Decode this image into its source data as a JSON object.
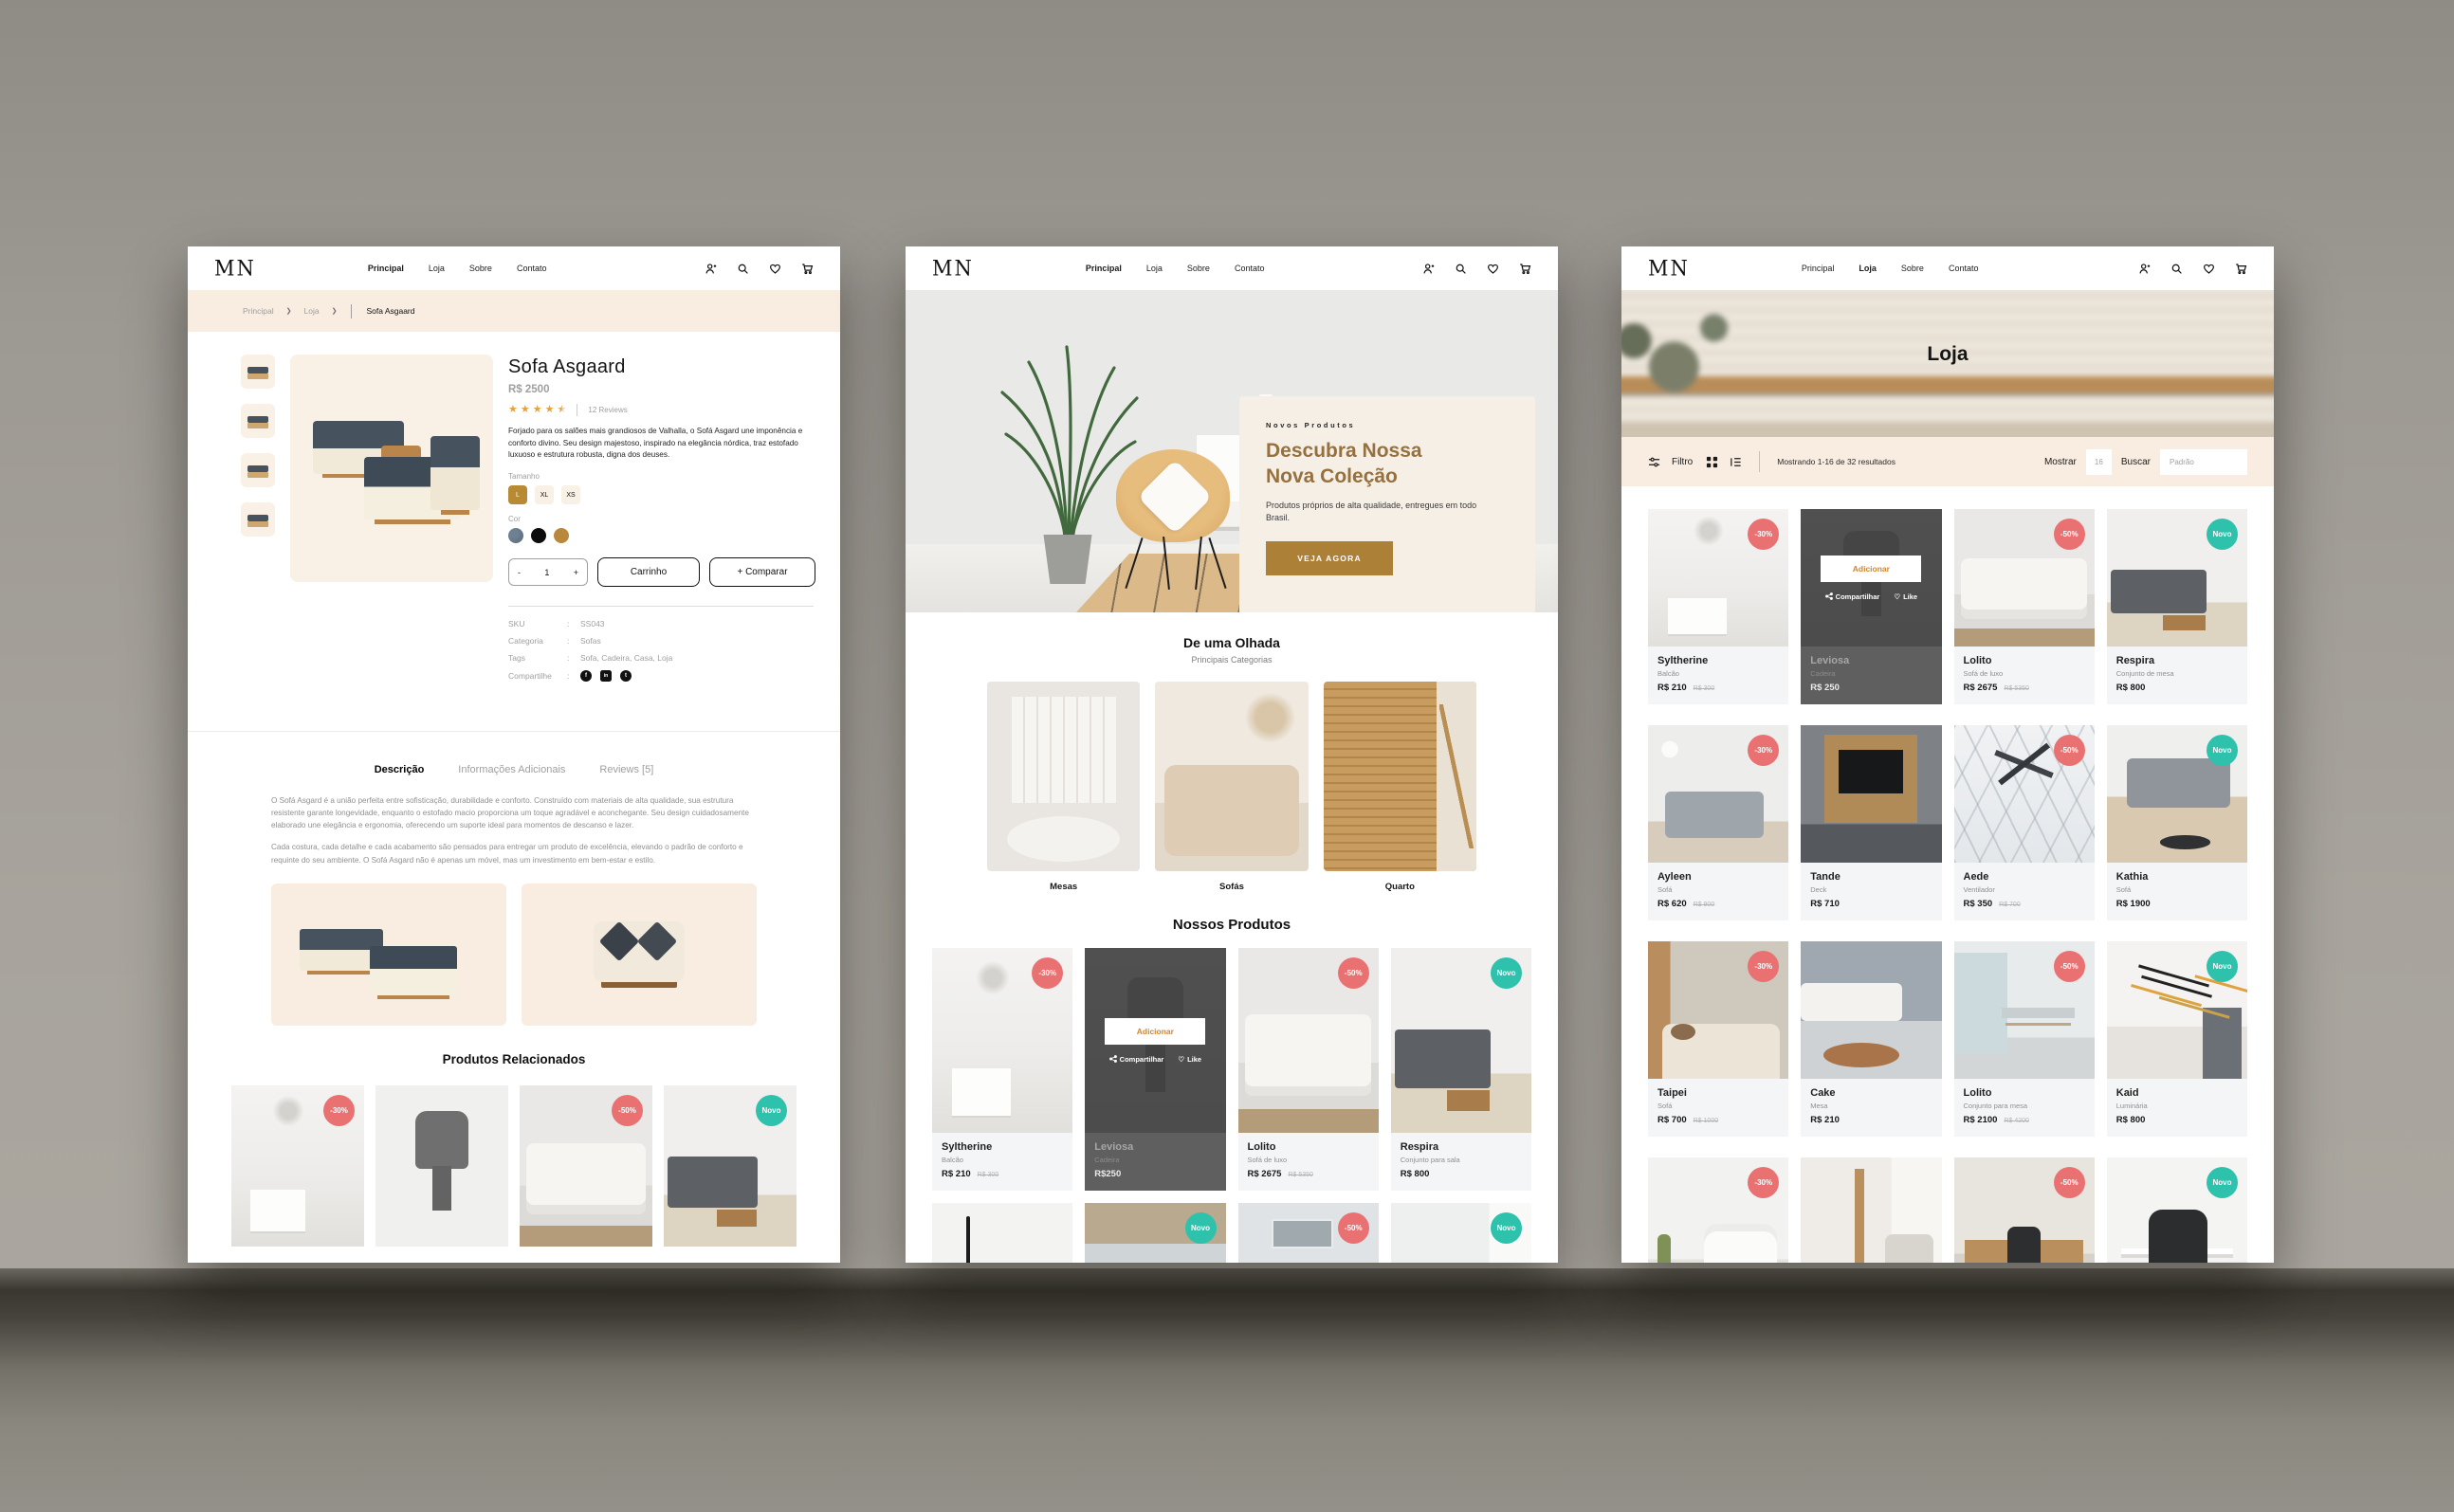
{
  "theme": {
    "accent": "#b88e2f",
    "sale_badge": "#e97171",
    "new_badge": "#2ec1ac",
    "cream": "#f9ece1",
    "cta_brown": "#ad8037"
  },
  "brand": {
    "logo": "MN"
  },
  "nav": {
    "items": [
      "Principal",
      "Loja",
      "Sobre",
      "Contato"
    ]
  },
  "icons": {
    "chevron": "❯",
    "star": "★",
    "heart": "♡",
    "facebook": "f",
    "linkedin": "in",
    "twitter": "t"
  },
  "hover": {
    "add": "Adicionar",
    "share": "Compartilhar",
    "like": "Like"
  },
  "detail": {
    "breadcrumb": {
      "items": [
        "Principal",
        "Loja"
      ],
      "current": "Sofa Asgaard"
    },
    "title": "Sofa Asgaard",
    "price": "R$ 2500",
    "reviews": "12 Reviews",
    "summary": "Forjado para os salões mais grandiosos de Valhalla, o Sofá Asgard une imponência e conforto divino. Seu design majestoso, inspirado na elegância nórdica, traz estofado luxuoso e estrutura robusta, digna dos deuses.",
    "size_label": "Tamanho",
    "sizes": [
      "L",
      "XL",
      "XS"
    ],
    "color_label": "Cor",
    "qty": {
      "minus": "-",
      "value": "1",
      "plus": "+"
    },
    "cart_button": "Carrinho",
    "compare_button": "+ Comparar",
    "meta": {
      "sep": ":",
      "sku_label": "SKU",
      "sku": "SS043",
      "cat_label": "Categoria",
      "cat": "Sofas",
      "tags_label": "Tags",
      "tags": "Sofa, Cadeira, Casa, Loja",
      "share_label": "Compartilhe"
    },
    "tabs": [
      "Descrição",
      "Informações Adicionais",
      "Reviews [5]"
    ],
    "paragraphs": [
      "O Sofá Asgard é a união perfeita entre sofisticação, durabilidade e conforto. Construído com materiais de alta qualidade, sua estrutura resistente garante longevidade, enquanto o estofado macio proporciona um toque agradável e aconchegante. Seu design cuidadosamente elaborado une elegância e ergonomia, oferecendo um suporte ideal para momentos de descanso e lazer.",
      "Cada costura, cada detalhe e cada acabamento são pensados para entregar um produto de excelência, elevando o padrão de conforto e requinte do seu ambiente. O Sofá Asgard não é apenas um móvel, mas um investimento em bem-estar e estilo."
    ],
    "related_title": "Produtos Relacionados",
    "related": [
      {
        "badge": "-30%"
      },
      {
        "badge": ""
      },
      {
        "badge": "-50%"
      },
      {
        "badge": "Novo"
      }
    ]
  },
  "home": {
    "hero": {
      "eyebrow": "Novos Produtos",
      "title1": "Descubra Nossa",
      "title2": "Nova Coleção",
      "text": "Produtos próprios de alta qualidade, entregues em todo Brasil.",
      "cta": "VEJA AGORA"
    },
    "glance_title": "De uma Olhada",
    "glance_subtitle": "Principais Categorias",
    "categories": [
      "Mesas",
      "Sofás",
      "Quarto"
    ],
    "products_title": "Nossos Produtos",
    "products": [
      {
        "name": "Syltherine",
        "category": "Balcão",
        "price": "R$ 210",
        "old_price": "R$ 300",
        "badge": "-30%"
      },
      {
        "name": "Leviosa",
        "category": "Cadeira",
        "price": "R$250"
      },
      {
        "name": "Lolito",
        "category": "Sofá de luxo",
        "price": "R$ 2675",
        "old_price": "R$ 5350",
        "badge": "-50%"
      },
      {
        "name": "Respira",
        "category": "Conjunto para sala",
        "price": "R$ 800",
        "badge": "Novo"
      }
    ],
    "partial_badges": [
      "",
      "Novo",
      "-50%",
      "Novo"
    ]
  },
  "shop": {
    "hero_title": "Loja",
    "toolbar": {
      "filter": "Filtro",
      "results": "Mostrando 1-16 de 32 resultados",
      "show_label": "Mostrar",
      "show_value": "16",
      "sort_label": "Buscar",
      "sort_value": "Padrão"
    },
    "products": [
      {
        "name": "Syltherine",
        "category": "Balcão",
        "price": "R$ 210",
        "old_price": "R$ 300",
        "badge": "-30%"
      },
      {
        "name": "Leviosa",
        "category": "Cadeira",
        "price": "R$ 250"
      },
      {
        "name": "Lolito",
        "category": "Sofá de luxo",
        "price": "R$ 2675",
        "old_price": "R$ 5350",
        "badge": "-50%"
      },
      {
        "name": "Respira",
        "category": "Conjunto de mesa",
        "price": "R$ 800",
        "badge": "Novo"
      },
      {
        "name": "Ayleen",
        "category": "Sofá",
        "price": "R$ 620",
        "old_price": "R$ 900",
        "badge": "-30%"
      },
      {
        "name": "Tande",
        "category": "Deck",
        "price": "R$ 710"
      },
      {
        "name": "Aede",
        "category": "Ventilador",
        "price": "R$ 350",
        "old_price": "R$ 700",
        "badge": "-50%"
      },
      {
        "name": "Kathia",
        "category": "Sofá",
        "price": "R$ 1900",
        "badge": "Novo"
      },
      {
        "name": "Taipei",
        "category": "Sofá",
        "price": "R$ 700",
        "old_price": "R$ 1000",
        "badge": "-30%"
      },
      {
        "name": "Cake",
        "category": "Mesa",
        "price": "R$ 210"
      },
      {
        "name": "Lolito",
        "category": "Conjunto para mesa",
        "price": "R$ 2100",
        "old_price": "R$ 4200",
        "badge": "-50%"
      },
      {
        "name": "Kaid",
        "category": "Luminária",
        "price": "R$ 800",
        "badge": "Novo"
      }
    ],
    "partial_badges": [
      "-30%",
      "",
      "-50%",
      "Novo"
    ]
  }
}
